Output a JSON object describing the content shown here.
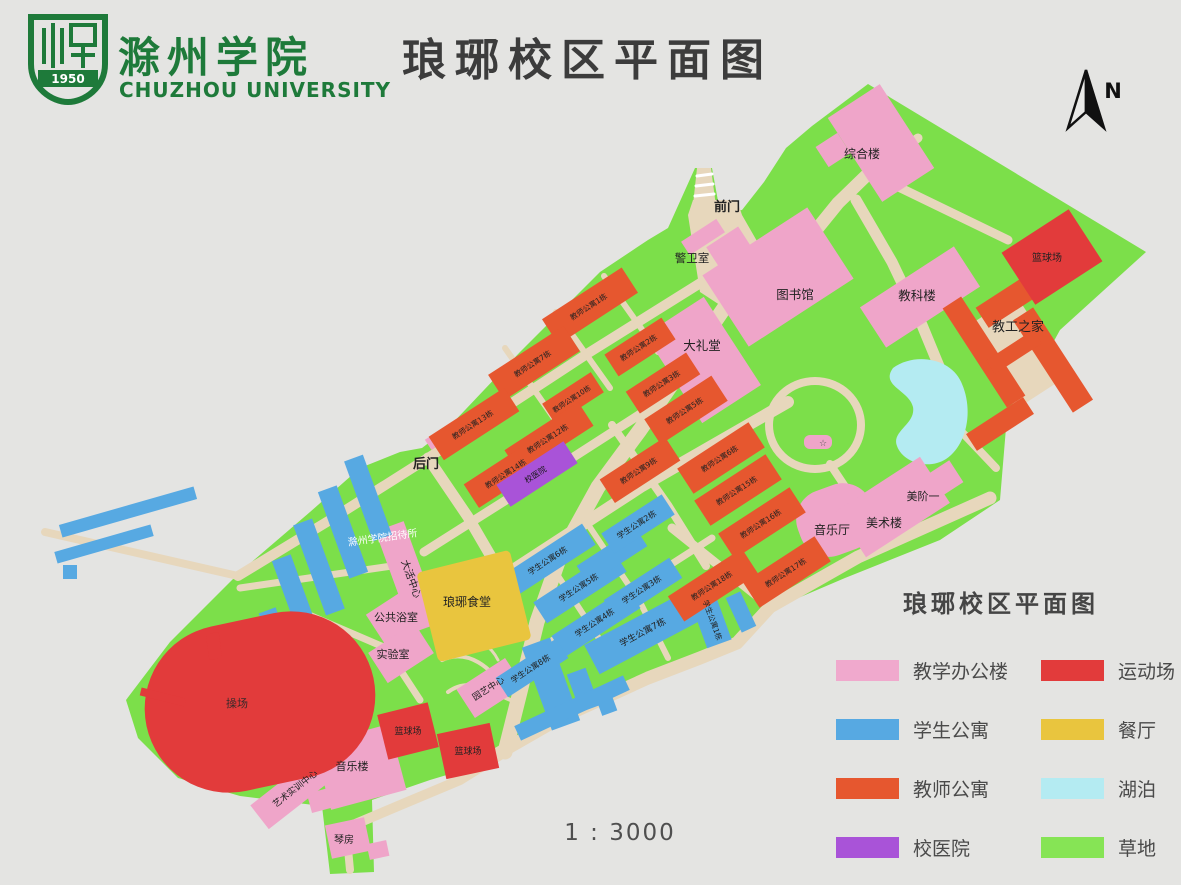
{
  "header": {
    "logo_title": "滁州学院",
    "logo_subtitle": "CHUZHOU UNIVERSITY",
    "logo_year": "1950",
    "logo_color": "#1e7a3a",
    "title": "琅琊校区平面图"
  },
  "compass": {
    "label": "N"
  },
  "scale": {
    "text": "1 : 3000"
  },
  "legend": {
    "title": "琅琊校区平面图",
    "items": [
      {
        "label": "教学办公楼",
        "color": "#f0a9cd"
      },
      {
        "label": "学生公寓",
        "color": "#57a9e2"
      },
      {
        "label": "教师公寓",
        "color": "#e6572f"
      },
      {
        "label": "校医院",
        "color": "#a953d8"
      },
      {
        "label": "运动场",
        "color": "#e23b3b"
      },
      {
        "label": "餐厅",
        "color": "#e9c53e"
      },
      {
        "label": "湖泊",
        "color": "#b4ebf2"
      },
      {
        "label": "草地",
        "color": "#86e455"
      }
    ]
  },
  "map": {
    "colors": {
      "grass": "#7cdf4a",
      "road": "#e7d7bc",
      "T": "#efa5c9",
      "S": "#57a9e2",
      "F": "#e6572f",
      "R": "#e23b3b",
      "D": "#e9c53e",
      "H": "#a953d8",
      "C": "#e7d7bc",
      "lake": "#b4ebf2"
    },
    "boundary": "868,84 1146,252 1060,330 1006,428 1000,500 940,540 845,578 770,610 736,646 700,662 648,682 560,722 470,768 430,780 372,800 374,872 330,874 322,806 240,796 178,778 138,738 126,700 170,642 240,572 310,512 360,468 400,452 422,448 448,428 520,352 560,312 600,272 648,240 668,228 695,168 712,168 720,212 742,210 764,182 786,148 812,126",
    "plazas": [
      "693,200 737,200 742,215 785,290 755,328 700,292 688,215",
      "697,168 711,168 717,214 692,214"
    ],
    "ring": {
      "cx": 815,
      "cy": 425,
      "rx": 46,
      "ry": 44,
      "w": 8
    },
    "lake": "M893,368 C915,352 952,358 962,384 C974,412 966,446 946,459 C929,470 903,463 897,446 C891,431 916,424 913,407 C909,390 880,386 893,368 Z",
    "roads": [
      {
        "d": "M742,282 L690,358 L640,430 L598,487 L560,556 L537,622 L520,692 L505,752",
        "w": 15
      },
      {
        "d": "M770,287 L838,203 L872,170",
        "w": 13
      },
      {
        "d": "M872,170 L918,138",
        "w": 9
      },
      {
        "d": "M880,178 L1008,240",
        "w": 9
      },
      {
        "d": "M856,200 L892,262 L922,325 L948,388 L958,428",
        "w": 11
      },
      {
        "d": "M958,428 L996,468",
        "w": 8
      },
      {
        "d": "M428,458 L590,352 L702,282",
        "w": 10
      },
      {
        "d": "M428,458 L330,520 L238,576",
        "w": 10
      },
      {
        "d": "M45,532 L238,576",
        "w": 8
      },
      {
        "d": "M428,458 L468,517 L500,572 L512,628",
        "w": 11
      },
      {
        "d": "M424,552 L544,476 L656,404",
        "w": 9
      },
      {
        "d": "M470,598 L642,486 L788,402",
        "w": 12
      },
      {
        "d": "M530,655 L712,538",
        "w": 7
      },
      {
        "d": "M480,764 L560,718 L648,678 L700,658 L737,643 L770,607 L858,557 L990,498",
        "w": 13
      },
      {
        "d": "M612,425 L668,505 L706,566",
        "w": 8
      },
      {
        "d": "M672,528 L762,600",
        "w": 9
      },
      {
        "d": "M585,520 L640,602 L668,658",
        "w": 6
      },
      {
        "d": "M545,556 L600,640",
        "w": 6
      },
      {
        "d": "M505,348 L558,424",
        "w": 6
      },
      {
        "d": "M556,312 L610,388",
        "w": 6
      },
      {
        "d": "M604,276 L658,352",
        "w": 6
      },
      {
        "d": "M830,464 L858,506",
        "w": 8
      },
      {
        "d": "M505,752 L460,780 L398,806 L346,828",
        "w": 10
      },
      {
        "d": "M346,828 L350,870",
        "w": 8
      },
      {
        "d": "M240,588 L392,566",
        "w": 7
      },
      {
        "d": "M302,612 L386,648 L420,700",
        "w": 7
      },
      {
        "d": "M442,660 C468,648 492,668 504,690",
        "w": 4
      },
      {
        "d": "M448,692 C472,674 496,696 516,702",
        "w": 4
      },
      {
        "d": "M460,642 C480,636 492,648 498,660",
        "w": 3
      },
      {
        "d": "M697,176 L712,174",
        "w": 3,
        "c": "#ffffff"
      },
      {
        "d": "M696,186 L713,184",
        "w": 3,
        "c": "#ffffff"
      },
      {
        "d": "M695,196 L714,194",
        "w": 3,
        "c": "#ffffff"
      }
    ],
    "buildings": [
      {
        "x": 1016,
        "y": 352,
        "w": 62,
        "h": 96,
        "a": -33,
        "t": "C"
      },
      {
        "x": 881,
        "y": 143,
        "w": 62,
        "h": 100,
        "a": -33,
        "t": "T",
        "n": "综合楼",
        "fs": 12,
        "lx": 862,
        "ly": 158
      },
      {
        "x": 833,
        "y": 150,
        "w": 26,
        "h": 24,
        "a": -33,
        "t": "T"
      },
      {
        "x": 778,
        "y": 277,
        "w": 125,
        "h": 85,
        "a": -33,
        "t": "T",
        "n": "图书馆",
        "fs": 12.5,
        "lx": 795,
        "ly": 299
      },
      {
        "x": 732,
        "y": 252,
        "w": 38,
        "h": 36,
        "a": -33,
        "t": "T"
      },
      {
        "x": 920,
        "y": 297,
        "w": 112,
        "h": 48,
        "a": -33,
        "t": "T",
        "n": "教科楼",
        "fs": 12.5,
        "lx": 917,
        "ly": 300
      },
      {
        "x": 703,
        "y": 360,
        "w": 70,
        "h": 105,
        "a": -33,
        "t": "T",
        "n": "大礼堂",
        "fs": 12.5,
        "lx": 702,
        "ly": 350
      },
      {
        "x": 703,
        "y": 237,
        "w": 42,
        "h": 16,
        "a": -33,
        "t": "T",
        "n": "警卫室",
        "fs": 11.5,
        "lx": 692,
        "ly": 262
      },
      {
        "x": 836,
        "y": 520,
        "w": 78,
        "h": 68,
        "a": -20,
        "r": 30,
        "t": "T",
        "n": "音乐厅",
        "fs": 12,
        "lx": 832,
        "ly": 534
      },
      {
        "x": 893,
        "y": 507,
        "w": 100,
        "h": 55,
        "a": -33,
        "t": "T",
        "n": "美术楼",
        "fs": 12,
        "lx": 884,
        "ly": 527
      },
      {
        "x": 932,
        "y": 487,
        "w": 58,
        "h": 26,
        "a": -33,
        "t": "T",
        "n": "美阶一",
        "fs": 11,
        "lx": 923,
        "ly": 500
      },
      {
        "x": 408,
        "y": 577,
        "w": 30,
        "h": 108,
        "a": -20,
        "t": "T",
        "n": "大活中心",
        "fs": 10,
        "la": 70
      },
      {
        "x": 400,
        "y": 614,
        "w": 58,
        "h": 36,
        "a": -33,
        "t": "T",
        "n": "公共浴室",
        "fs": 11,
        "lx": 396,
        "ly": 621
      },
      {
        "x": 401,
        "y": 653,
        "w": 55,
        "h": 36,
        "a": -33,
        "t": "T",
        "n": "实验室",
        "fs": 11,
        "lx": 393,
        "ly": 658
      },
      {
        "x": 490,
        "y": 688,
        "w": 58,
        "h": 34,
        "a": -33,
        "t": "T",
        "n": "园艺中心",
        "fs": 9,
        "la": -33
      },
      {
        "x": 818,
        "y": 442,
        "w": 28,
        "h": 14,
        "a": 0,
        "r": 6,
        "t": "T"
      },
      {
        "x": 360,
        "y": 767,
        "w": 78,
        "h": 68,
        "a": -15,
        "t": "T",
        "n": "音乐楼",
        "fs": 11,
        "lx": 352,
        "ly": 770
      },
      {
        "x": 400,
        "y": 744,
        "w": 26,
        "h": 22,
        "a": -15,
        "t": "T"
      },
      {
        "x": 322,
        "y": 800,
        "w": 26,
        "h": 20,
        "a": -15,
        "t": "T"
      },
      {
        "x": 297,
        "y": 788,
        "w": 95,
        "h": 30,
        "a": -38,
        "t": "T",
        "n": "艺术实训中心",
        "fs": 9,
        "la": -38
      },
      {
        "x": 348,
        "y": 838,
        "w": 40,
        "h": 34,
        "a": -12,
        "t": "T",
        "n": "琴房",
        "fs": 10,
        "lx": 344,
        "ly": 843
      },
      {
        "x": 378,
        "y": 850,
        "w": 20,
        "h": 16,
        "a": -12,
        "t": "T"
      },
      {
        "x": 434,
        "y": 441,
        "w": 14,
        "h": 12,
        "a": -33,
        "t": "T"
      },
      {
        "x": 368,
        "y": 498,
        "w": 20,
        "h": 85,
        "a": -20,
        "t": "S"
      },
      {
        "x": 343,
        "y": 532,
        "w": 20,
        "h": 92,
        "a": -20,
        "t": "S"
      },
      {
        "x": 319,
        "y": 567,
        "w": 20,
        "h": 96,
        "a": -20,
        "t": "S"
      },
      {
        "x": 297,
        "y": 601,
        "w": 20,
        "h": 92,
        "a": -20,
        "t": "S"
      },
      {
        "x": 275,
        "y": 632,
        "w": 18,
        "h": 46,
        "a": -20,
        "t": "S"
      },
      {
        "x": 128,
        "y": 512,
        "w": 140,
        "h": 13,
        "a": -16,
        "t": "S"
      },
      {
        "x": 104,
        "y": 544,
        "w": 100,
        "h": 12,
        "a": -16,
        "t": "S"
      },
      {
        "x": 70,
        "y": 572,
        "w": 14,
        "h": 14,
        "a": 0,
        "t": "S"
      },
      {
        "x": 549,
        "y": 560,
        "w": 95,
        "h": 25,
        "a": -33,
        "t": "S",
        "n": "学生公寓6栋",
        "fs": 8,
        "la": -33
      },
      {
        "x": 580,
        "y": 587,
        "w": 95,
        "h": 25,
        "a": -33,
        "t": "S",
        "n": "学生公寓5栋",
        "fs": 8,
        "la": -33
      },
      {
        "x": 596,
        "y": 622,
        "w": 90,
        "h": 25,
        "a": -33,
        "t": "S",
        "n": "学生公寓4栋",
        "fs": 8,
        "la": -33
      },
      {
        "x": 612,
        "y": 556,
        "w": 70,
        "h": 22,
        "a": -33,
        "t": "S"
      },
      {
        "x": 638,
        "y": 524,
        "w": 72,
        "h": 24,
        "a": -33,
        "t": "S",
        "n": "学生公寓2栋",
        "fs": 8,
        "la": -33
      },
      {
        "x": 643,
        "y": 589,
        "w": 78,
        "h": 24,
        "a": -33,
        "t": "S",
        "n": "学生公寓3栋",
        "fs": 8,
        "la": -33
      },
      {
        "x": 644,
        "y": 632,
        "w": 118,
        "h": 33,
        "a": -28,
        "t": "S",
        "n": "学生公寓7栋",
        "fs": 9,
        "la": -28
      },
      {
        "x": 710,
        "y": 618,
        "w": 26,
        "h": 55,
        "a": -20,
        "t": "S",
        "n": "学生公寓1栋",
        "fs": 7.5,
        "la": 70
      },
      {
        "x": 532,
        "y": 668,
        "w": 72,
        "h": 23,
        "a": -33,
        "t": "S",
        "n": "学生公寓8栋",
        "fs": 8,
        "la": -33
      },
      {
        "x": 551,
        "y": 684,
        "w": 30,
        "h": 88,
        "a": -20,
        "t": "S"
      },
      {
        "x": 583,
        "y": 690,
        "w": 20,
        "h": 40,
        "a": -20,
        "t": "S"
      },
      {
        "x": 605,
        "y": 700,
        "w": 16,
        "h": 28,
        "a": -20,
        "t": "S"
      },
      {
        "x": 572,
        "y": 708,
        "w": 120,
        "h": 16,
        "a": -25,
        "t": "S"
      },
      {
        "x": 741,
        "y": 612,
        "w": 16,
        "h": 38,
        "a": -25,
        "t": "S"
      },
      {
        "x": 590,
        "y": 306,
        "w": 95,
        "h": 30,
        "a": -33,
        "t": "F",
        "n": "教师公寓1栋",
        "fs": 7.5,
        "la": -33
      },
      {
        "x": 640,
        "y": 347,
        "w": 68,
        "h": 26,
        "a": -33,
        "t": "F",
        "n": "教师公寓2栋",
        "fs": 7.5,
        "la": -33
      },
      {
        "x": 663,
        "y": 383,
        "w": 72,
        "h": 26,
        "a": -33,
        "t": "F",
        "n": "教师公寓3栋",
        "fs": 7.5,
        "la": -33
      },
      {
        "x": 534,
        "y": 363,
        "w": 90,
        "h": 30,
        "a": -33,
        "t": "F",
        "n": "教师公寓7栋",
        "fs": 7.5,
        "la": -33
      },
      {
        "x": 573,
        "y": 398,
        "w": 58,
        "h": 24,
        "a": -33,
        "t": "F",
        "n": "教师公寓10栋",
        "fs": 7,
        "la": -33
      },
      {
        "x": 474,
        "y": 424,
        "w": 90,
        "h": 28,
        "a": -33,
        "t": "F",
        "n": "教师公寓13栋",
        "fs": 7.5,
        "la": -33
      },
      {
        "x": 549,
        "y": 438,
        "w": 88,
        "h": 28,
        "a": -33,
        "t": "F",
        "n": "教师公寓12栋",
        "fs": 7.5,
        "la": -33
      },
      {
        "x": 507,
        "y": 473,
        "w": 85,
        "h": 28,
        "a": -33,
        "t": "F",
        "n": "教师公寓14栋",
        "fs": 7.5,
        "la": -33
      },
      {
        "x": 640,
        "y": 470,
        "w": 78,
        "h": 28,
        "a": -33,
        "t": "F",
        "n": "教师公寓9栋",
        "fs": 7.5,
        "la": -33
      },
      {
        "x": 686,
        "y": 410,
        "w": 80,
        "h": 30,
        "a": -33,
        "t": "F",
        "n": "教师公寓5栋",
        "fs": 7.5,
        "la": -33
      },
      {
        "x": 721,
        "y": 458,
        "w": 85,
        "h": 30,
        "a": -33,
        "t": "F",
        "n": "教师公寓6栋",
        "fs": 7.5,
        "la": -33
      },
      {
        "x": 738,
        "y": 490,
        "w": 85,
        "h": 30,
        "a": -33,
        "t": "F",
        "n": "教师公寓15栋",
        "fs": 7.5,
        "la": -33
      },
      {
        "x": 762,
        "y": 523,
        "w": 85,
        "h": 30,
        "a": -33,
        "t": "F",
        "n": "教师公寓16栋",
        "fs": 7.5,
        "la": -33
      },
      {
        "x": 787,
        "y": 572,
        "w": 85,
        "h": 30,
        "a": -33,
        "t": "F",
        "n": "教师公寓17栋",
        "fs": 7.5,
        "la": -33
      },
      {
        "x": 713,
        "y": 585,
        "w": 88,
        "h": 30,
        "a": -33,
        "t": "F",
        "n": "教师公寓18栋",
        "fs": 7.5,
        "la": -33
      },
      {
        "x": 1022,
        "y": 292,
        "w": 95,
        "h": 24,
        "a": -33,
        "t": "F"
      },
      {
        "x": 1053,
        "y": 360,
        "w": 24,
        "h": 110,
        "a": -33,
        "t": "F"
      },
      {
        "x": 984,
        "y": 352,
        "w": 22,
        "h": 118,
        "a": -33,
        "t": "F"
      },
      {
        "x": 1000,
        "y": 424,
        "w": 68,
        "h": 20,
        "a": -33,
        "t": "F"
      },
      {
        "x": 1014,
        "y": 352,
        "w": 56,
        "h": 16,
        "a": -33,
        "t": "F"
      },
      {
        "x": 260,
        "y": 702,
        "w": 232,
        "h": 168,
        "a": -12,
        "r": 84,
        "t": "R",
        "n": "操场",
        "fs": 11,
        "lx": 237,
        "ly": 707,
        "lc": "#3a2a2a"
      },
      {
        "x": 1052,
        "y": 257,
        "w": 80,
        "h": 62,
        "a": -33,
        "t": "R",
        "n": "篮球场",
        "fs": 10,
        "lx": 1047,
        "ly": 261
      },
      {
        "x": 408,
        "y": 731,
        "w": 52,
        "h": 46,
        "a": -14,
        "t": "R",
        "n": "篮球场",
        "fs": 9
      },
      {
        "x": 468,
        "y": 751,
        "w": 54,
        "h": 46,
        "a": -12,
        "t": "R",
        "n": "篮球场",
        "fs": 9
      },
      {
        "x": 163,
        "y": 697,
        "w": 46,
        "h": 8,
        "a": 14,
        "t": "R"
      },
      {
        "x": 214,
        "y": 646,
        "w": 13,
        "h": 26,
        "a": -8,
        "t": "R"
      },
      {
        "x": 474,
        "y": 606,
        "w": 96,
        "h": 92,
        "a": -14,
        "r": 5,
        "t": "D",
        "n": "琅琊食堂",
        "fs": 12,
        "lx": 467,
        "ly": 606
      },
      {
        "x": 537,
        "y": 474,
        "w": 80,
        "h": 26,
        "a": -33,
        "t": "H",
        "n": "校医院",
        "fs": 8,
        "la": -33,
        "lc": "#1a1a1a"
      }
    ],
    "labels": [
      {
        "t": "前门",
        "x": 727,
        "y": 211,
        "s": 13,
        "b": 1
      },
      {
        "t": "后门",
        "x": 426,
        "y": 468,
        "s": 13,
        "b": 1
      },
      {
        "t": "滁州学院招待所",
        "x": 383,
        "y": 541,
        "s": 10,
        "c": "#ffffff",
        "r": -8
      },
      {
        "t": "教工之家",
        "x": 1018,
        "y": 331,
        "s": 13
      },
      {
        "t": "☆",
        "x": 823,
        "y": 446,
        "s": 9,
        "c": "#555555"
      }
    ]
  }
}
